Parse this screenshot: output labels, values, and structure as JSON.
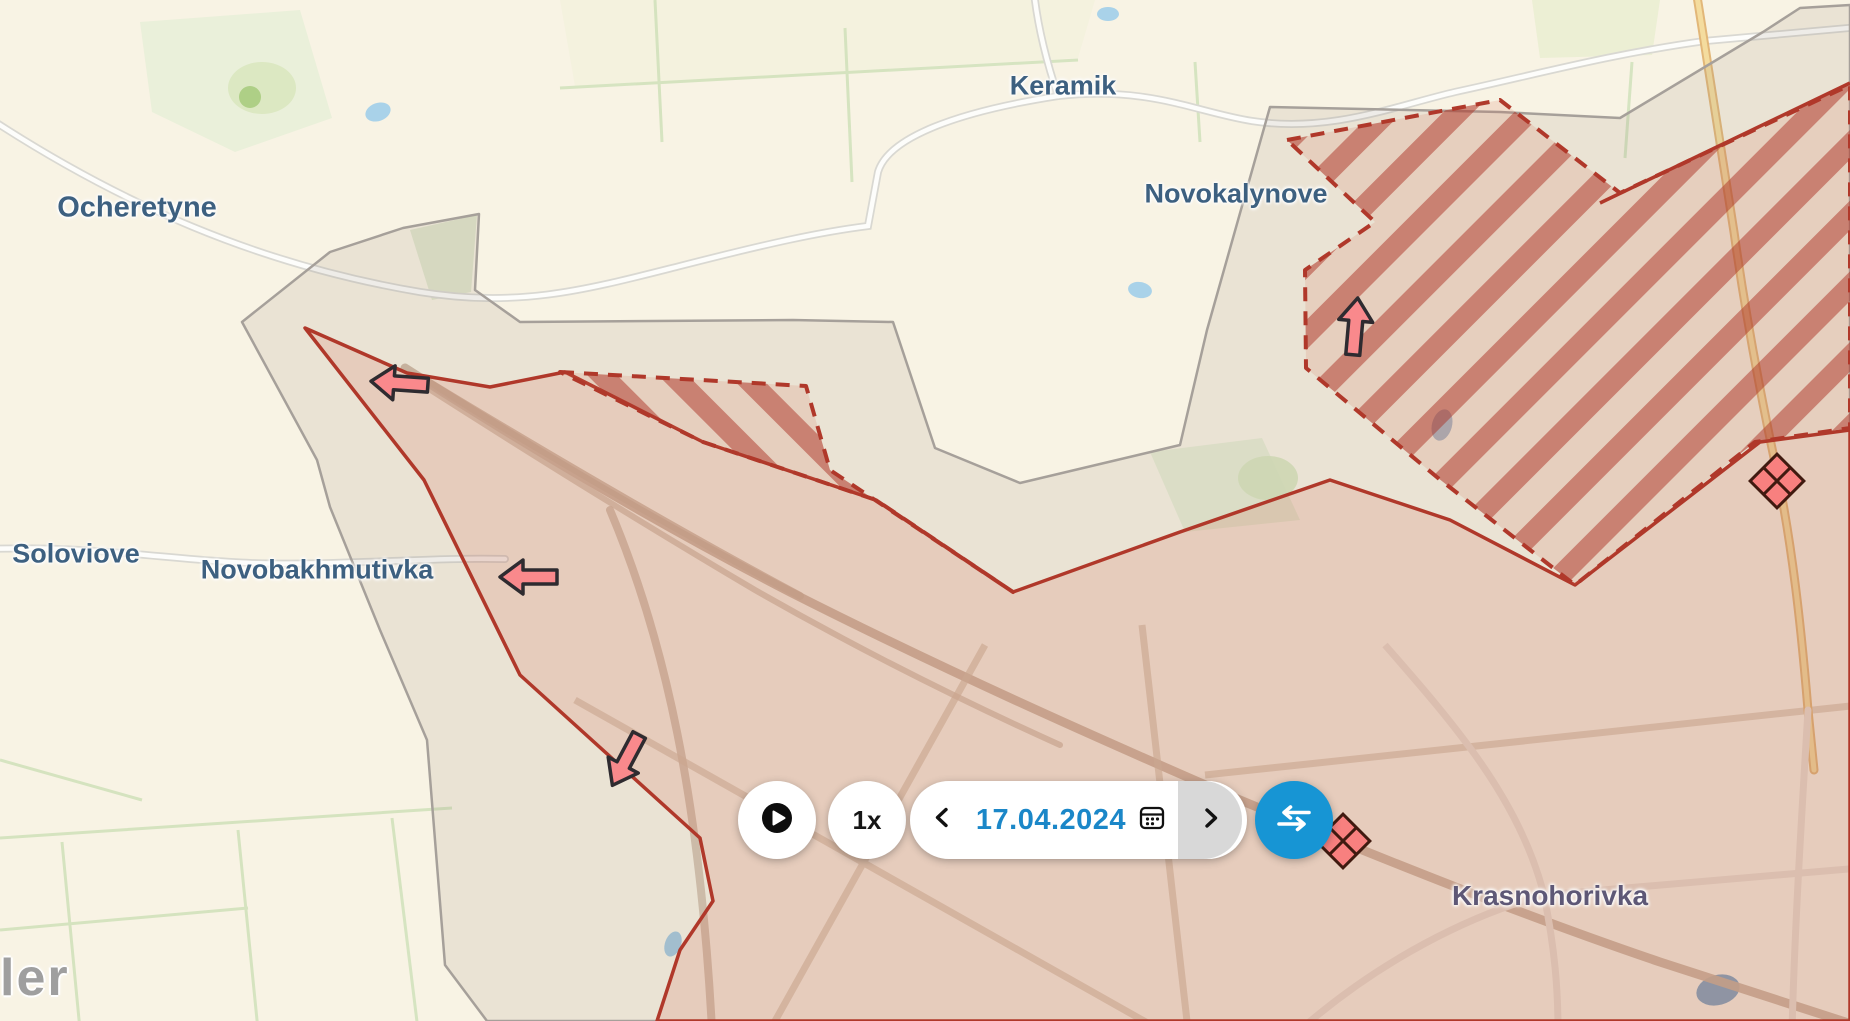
{
  "map": {
    "towns": {
      "ocheretyne": "Ocheretyne",
      "keramik": "Keramik",
      "novokalynove": "Novokalynove",
      "soloviove": "Soloviove",
      "novobakhmutivka": "Novobakhmutivka",
      "krasnohorivka": "Krasnohorivka"
    },
    "watermark_fragment": "ler",
    "zones": {
      "occupied_label": "occupied area",
      "advance_label": "claimed advance (hatched)",
      "buffer_label": "gray zone"
    },
    "arrows": [
      {
        "name": "advance-arrow-west-1",
        "direction": "left"
      },
      {
        "name": "advance-arrow-west-2",
        "direction": "left"
      },
      {
        "name": "advance-arrow-south",
        "direction": "down-left"
      },
      {
        "name": "advance-arrow-north",
        "direction": "up"
      }
    ],
    "markers": [
      {
        "name": "clash-marker-east",
        "type": "diamond-cluster"
      },
      {
        "name": "clash-marker-center",
        "type": "diamond-cluster"
      }
    ],
    "colors": {
      "occupied_border": "#b0382a",
      "hatch_stripe": "#ac3426",
      "buffer_border": "#a6a09a",
      "arrow_fill": "#f9898c",
      "marker_fill": "#f8807f"
    }
  },
  "timebar": {
    "play_icon": "play-icon",
    "speed": "1x",
    "date": "17.04.2024",
    "prev_icon": "chevron-left-icon",
    "next_icon": "chevron-right-icon",
    "calendar_icon": "calendar-icon",
    "compare_icon": "swap-arrows-icon",
    "accent_blue": "#1795d4",
    "date_color": "#1b87c8"
  }
}
